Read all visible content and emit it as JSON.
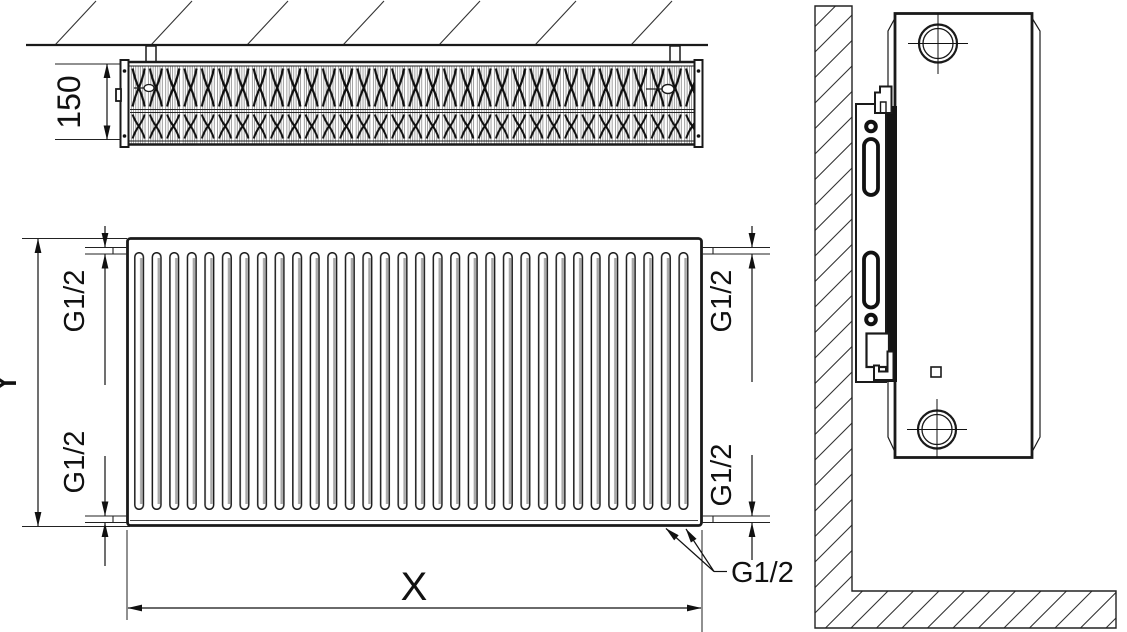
{
  "drawing": {
    "background": "#ffffff",
    "line_color": "#1a1a1a",
    "labels": {
      "depth": "150",
      "height": "Y",
      "width": "X",
      "thread_top_left": "G1/2",
      "thread_bottom_left": "G1/2",
      "thread_top_right": "G1/2",
      "thread_bottom_right": "G1/2",
      "thread_bottom_callout": "G1/2"
    }
  }
}
